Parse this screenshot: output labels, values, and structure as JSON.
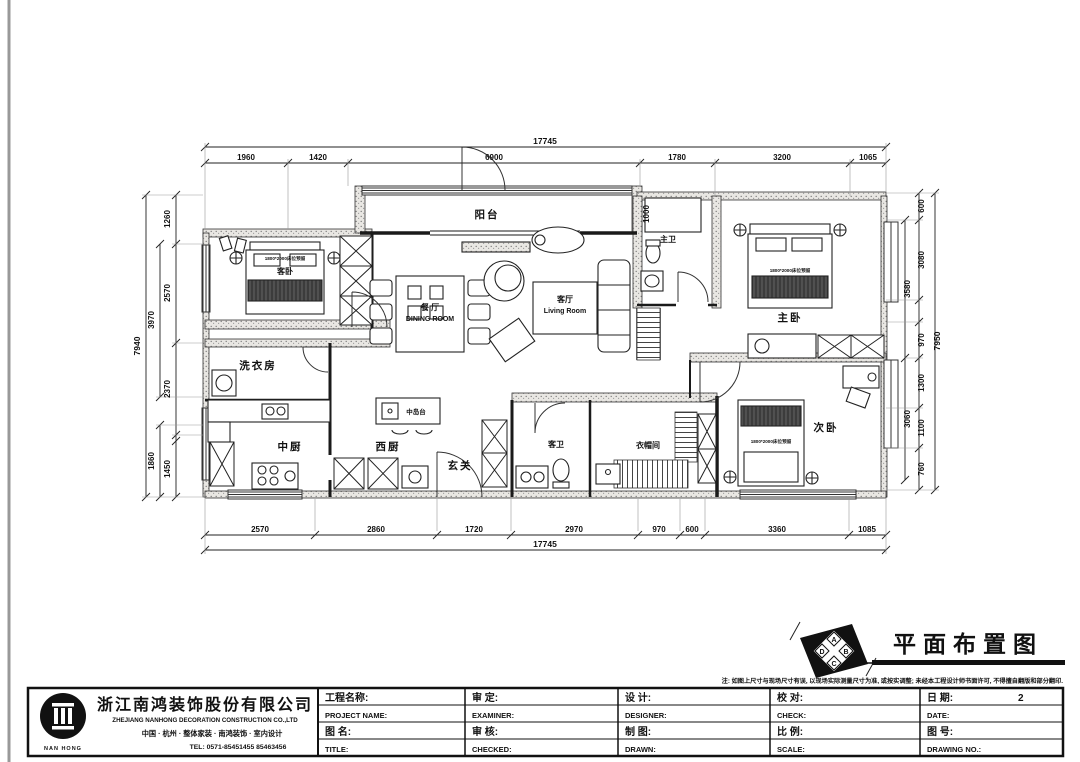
{
  "drawing": {
    "title": "平面布置图",
    "note": "注: 如图上尺寸与现场尺寸有误, 以现场实际测量尺寸为准, 或按实调整; 未经本工程设计师书面许可, 不得擅自翻版和部分翻印.",
    "compass": {
      "a": "A",
      "b": "B",
      "c": "C",
      "d": "D"
    }
  },
  "plan": {
    "rooms": [
      {
        "label": "阳台"
      },
      {
        "label": "客卧"
      },
      {
        "label": "餐 厅",
        "sub": "DINING ROOM"
      },
      {
        "label": "客厅",
        "sub": "Living Room"
      },
      {
        "label": "主卫"
      },
      {
        "label": "主卧"
      },
      {
        "label": "洗衣房"
      },
      {
        "label": "中厨"
      },
      {
        "label": "西厨"
      },
      {
        "label": "玄关"
      },
      {
        "label": "客卫"
      },
      {
        "label": "衣帽间"
      },
      {
        "label": "次卧"
      }
    ],
    "annotations": {
      "island": "中岛台",
      "bed_note": "1800*2000床位预留",
      "bath_dim": "1000"
    }
  },
  "dims": {
    "top": {
      "overall": "17745",
      "segments": [
        "1960",
        "1420",
        "6900",
        "1780",
        "3200",
        "1065"
      ]
    },
    "bottom": {
      "overall": "17745",
      "segments": [
        "2570",
        "2860",
        "1720",
        "2970",
        "970",
        "600",
        "3360",
        "1085"
      ]
    },
    "left": {
      "overall": "7940",
      "segments": [
        "1260",
        "2570",
        "3970",
        "2370",
        "1860",
        "1450"
      ]
    },
    "right": {
      "overall": "7950",
      "segments": [
        "600",
        "3080",
        "3580",
        "970",
        "1300",
        "1100",
        "3060",
        "760"
      ]
    }
  },
  "title_block": {
    "company": {
      "name": "浙江南鸿装饰股份有限公司",
      "name_en": "ZHEJIANG NANHONG DECORATION CONSTRUCTION CO.,LTD",
      "tagline": "中国 · 杭州 · 整体家装 · 南鸿装饰 · 室内设计",
      "tel": "TEL: 0571-85451455 85463456",
      "logo_text": "NAN HONG"
    },
    "fields": [
      {
        "cn": "工程名称:",
        "en": "PROJECT NAME:",
        "value": ""
      },
      {
        "cn": "图  名:",
        "en": "TITLE:",
        "value": ""
      },
      {
        "cn": "审  定:",
        "en": "EXAMINER:",
        "value": ""
      },
      {
        "cn": "审  核:",
        "en": "CHECKED:",
        "value": ""
      },
      {
        "cn": "设  计:",
        "en": "DESIGNER:",
        "value": ""
      },
      {
        "cn": "制  图:",
        "en": "DRAWN:",
        "value": ""
      },
      {
        "cn": "校  对:",
        "en": "CHECK:",
        "value": ""
      },
      {
        "cn": "比  例:",
        "en": "SCALE:",
        "value": ""
      },
      {
        "cn": "日  期:",
        "en": "DATE:",
        "value": "2"
      },
      {
        "cn": "图  号:",
        "en": "DRAWING NO.:",
        "value": ""
      }
    ]
  }
}
